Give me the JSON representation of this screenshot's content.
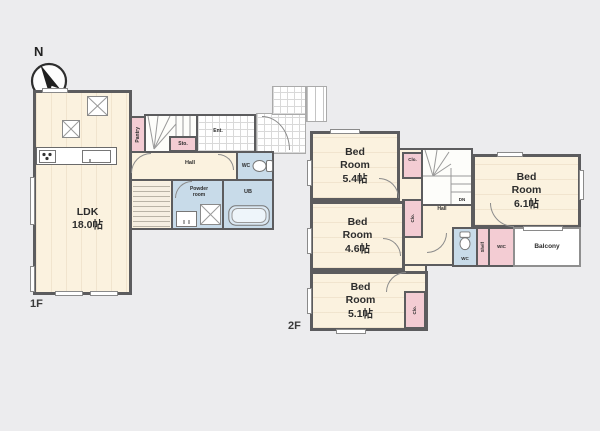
{
  "compass": {
    "north": "N"
  },
  "floor1": {
    "label": "1F",
    "ldk": "LDK\n18.0帖",
    "pantry": "Pantry",
    "storage": "Sto.",
    "up": "UP",
    "shoe_box": "SB",
    "entrance": "Ent.",
    "hall": "Hall",
    "wc": "WC",
    "powder_room": "Powder\nroom",
    "unit_bath": "UB"
  },
  "floor2": {
    "label": "2F",
    "bedroom_a": "Bed\nRoom\n5.4帖",
    "closet_a": "Clo.",
    "hall": "Hall",
    "down": "DN",
    "bedroom_b": "Bed\nRoom\n6.1帖",
    "closet_b": "Clo.",
    "bedroom_c": "Bed\nRoom\n4.6帖",
    "bedroom_d": "Bed\nRoom\n5.1帖",
    "closet_c": "Clo.",
    "wc": "WC",
    "shelf": "Shelf",
    "wic": "WIC",
    "balcony": "Balcony"
  },
  "colors": {
    "background": "#ececee",
    "wall": "#5c5c5e",
    "room_fill": "#fbf2df",
    "closet_fill": "#f3ccd3",
    "wet_fill": "#c8dbe9"
  }
}
